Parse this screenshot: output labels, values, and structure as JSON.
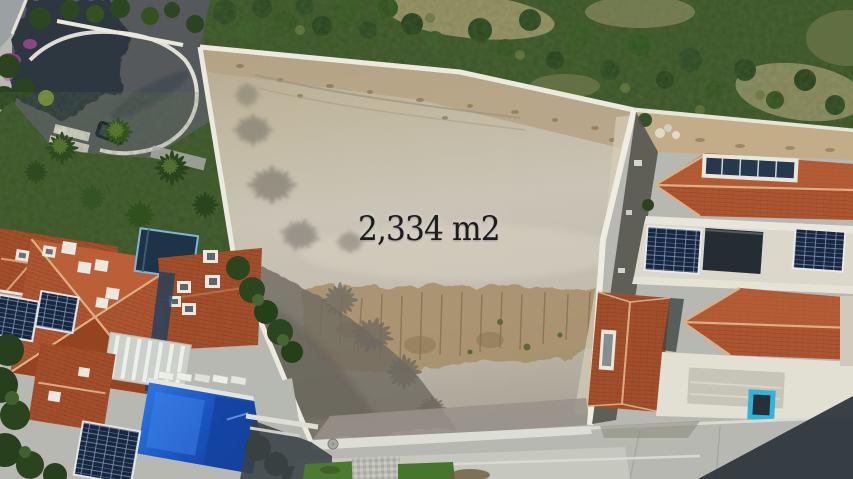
{
  "image": {
    "overlay": {
      "area_label": "2,334 m2"
    },
    "palette": {
      "lot_top": "#b6a98f",
      "lot_mid": "#cbc6b8",
      "lot_low": "#aaa598",
      "erosion_brown": "#a78f6a",
      "debris_tan": "#b4a182",
      "wall_white": "#ece9de",
      "roof_terracotta": "#ad5530",
      "roof_terracotta2": "#a24e2a",
      "roof_dark": "#8a3f1f",
      "ridge_cream": "#d9ac80",
      "pool_blue": "#1a55c0",
      "pool_blue2": "#2d74e0",
      "cyan_pool": "#2fb4dc",
      "solar_navy": "#17273f",
      "street_gray": "#b7b8b2",
      "sidewalk_gray": "#c6c7bf",
      "road_dark": "#56595b",
      "shadow_dark": "#2a333b",
      "veg_green": "#3b5426",
      "veg_dark": "#2c4620",
      "veg_olive": "#6d7b40",
      "dry_grass": "#b3a276",
      "grass_green": "#4c7a2e",
      "backyard_dirt": "#c2ad88",
      "flat_roof": "#dbd7cb",
      "terrace_white": "#e2dfd3",
      "bougainvillea": "#a13a90",
      "courtyard_navy": "#1d3347",
      "courtyard_trim": "#7fb6d6"
    }
  }
}
